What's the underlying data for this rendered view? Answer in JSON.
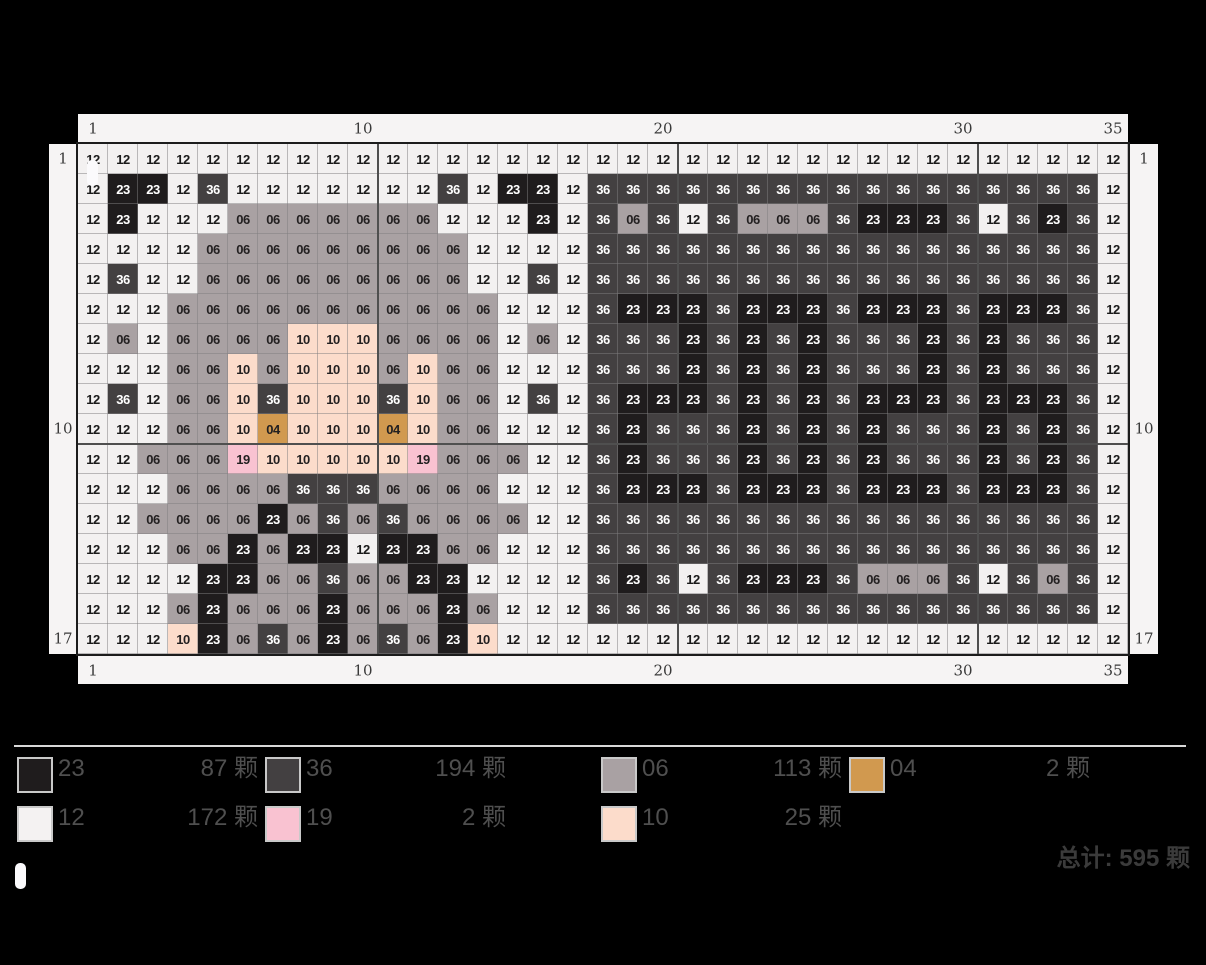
{
  "page": {
    "background": "#000000",
    "panel_color": "#f6f4f4"
  },
  "axis": {
    "top_labels": [
      {
        "text": "1",
        "col": 1
      },
      {
        "text": "10",
        "col": 10
      },
      {
        "text": "20",
        "col": 20
      },
      {
        "text": "30",
        "col": 30
      },
      {
        "text": "35",
        "col": 35
      }
    ],
    "bottom_labels": [
      {
        "text": "1",
        "col": 1
      },
      {
        "text": "10",
        "col": 10
      },
      {
        "text": "20",
        "col": 20
      },
      {
        "text": "30",
        "col": 30
      },
      {
        "text": "35",
        "col": 35
      }
    ],
    "left_labels": [
      {
        "text": "1",
        "row": 1
      },
      {
        "text": "10",
        "row": 10
      },
      {
        "text": "17",
        "row": 17
      }
    ],
    "right_labels": [
      {
        "text": "1",
        "row": 1
      },
      {
        "text": "10",
        "row": 10
      },
      {
        "text": "17",
        "row": 17
      }
    ]
  },
  "chart_data": {
    "type": "heatmap",
    "description": "Fuse-bead pixel pattern grid, 35 columns x 17 rows; each cell shows its bead color code",
    "cols": 35,
    "rows": 17,
    "section_size": 10,
    "cell_codes_rows": [
      "12 12 12 12 12 12 12 12 12 12 12 12 12 12 12 12 12 12 12 12 12 12 12 12 12 12 12 12 12 12 12 12 12 12 12",
      "12 23 23 12 36 12 12 12 12 12 12 12 36 12 23 23 12 36 36 36 36 36 36 36 36 36 36 36 36 36 36 36 36 36 12",
      "12 23 12 12 12 06 06 06 06 06 06 06 12 12 12 23 12 36 06 36 12 36 06 06 06 36 23 23 23 36 12 36 23 36 12",
      "12 12 12 12 06 06 06 06 06 06 06 06 06 12 12 12 12 36 36 36 36 36 36 36 36 36 36 36 36 36 36 36 36 36 12",
      "12 36 12 12 06 06 06 06 06 06 06 06 06 12 12 36 12 36 36 36 36 36 36 36 36 36 36 36 36 36 36 36 36 36 12",
      "12 12 12 06 06 06 06 06 06 06 06 06 06 06 12 12 12 36 23 23 23 36 23 23 23 36 23 23 23 36 23 23 23 36 12",
      "12 06 12 06 06 06 06 10 10 10 06 06 06 06 12 06 12 36 36 36 23 36 23 36 23 36 36 36 23 36 23 36 36 36 12",
      "12 12 12 06 06 10 06 10 10 10 06 10 06 06 12 12 12 36 36 36 23 36 23 36 23 36 36 36 23 36 23 36 36 36 12",
      "12 36 12 06 06 10 36 10 10 10 36 10 06 06 12 36 12 36 23 23 23 36 23 36 23 36 23 23 23 36 23 23 23 36 12",
      "12 12 12 06 06 10 04 10 10 10 04 10 06 06 12 12 12 36 23 36 36 36 23 36 23 36 23 36 36 36 23 36 23 36 12",
      "12 12 06 06 06 19 10 10 10 10 10 19 06 06 06 12 12 36 23 36 36 36 23 36 23 36 23 36 36 36 23 36 23 36 12",
      "12 12 12 06 06 06 06 36 36 36 06 06 06 06 12 12 12 36 23 23 23 36 23 23 23 36 23 23 23 36 23 23 23 36 12",
      "12 12 06 06 06 06 23 06 36 06 36 06 06 06 06 12 12 36 36 36 36 36 36 36 36 36 36 36 36 36 36 36 36 36 12",
      "12 12 12 06 06 23 06 23 23 12 23 23 06 06 12 12 12 36 36 36 36 36 36 36 36 36 36 36 36 36 36 36 36 36 12",
      "12 12 12 12 23 23 06 06 36 06 06 23 23 12 12 12 12 36 23 36 12 36 23 23 23 36 06 06 06 36 12 36 06 36 12",
      "12 12 12 06 23 06 06 06 23 06 06 06 23 06 12 12 12 36 36 36 36 36 36 36 36 36 36 36 36 36 36 36 36 36 12",
      "12 12 12 10 23 06 36 06 23 06 36 06 23 10 12 12 12 12 12 12 12 12 12 12 12 12 12 12 12 12 12 12 12 12 12"
    ],
    "palette": {
      "12": {
        "bg": "#f3f1f1",
        "fg": "#1a1a1a"
      },
      "23": {
        "bg": "#1f1c1d",
        "fg": "#ffffff"
      },
      "36": {
        "bg": "#434041",
        "fg": "#ffffff"
      },
      "06": {
        "bg": "#a9a1a3",
        "fg": "#232021"
      },
      "10": {
        "bg": "#fcdccb",
        "fg": "#232021"
      },
      "04": {
        "bg": "#d1994f",
        "fg": "#232021"
      },
      "19": {
        "bg": "#f9c2d1",
        "fg": "#232021"
      }
    }
  },
  "legend": {
    "rows": [
      [
        {
          "code": "23",
          "count_label": "87 颗",
          "color": "#1f1c1d"
        },
        {
          "code": "36",
          "count_label": "194 颗",
          "color": "#434041"
        },
        {
          "code": "06",
          "count_label": "113 颗",
          "color": "#a9a1a3"
        },
        {
          "code": "04",
          "count_label": "2 颗",
          "color": "#d1994f"
        }
      ],
      [
        {
          "code": "12",
          "count_label": "172 颗",
          "color": "#f4f2f2"
        },
        {
          "code": "19",
          "count_label": "2 颗",
          "color": "#f9c2d1"
        },
        {
          "code": "10",
          "count_label": "25 颗",
          "color": "#fcdccb"
        }
      ]
    ],
    "total_label": "总计: 595 颗"
  }
}
